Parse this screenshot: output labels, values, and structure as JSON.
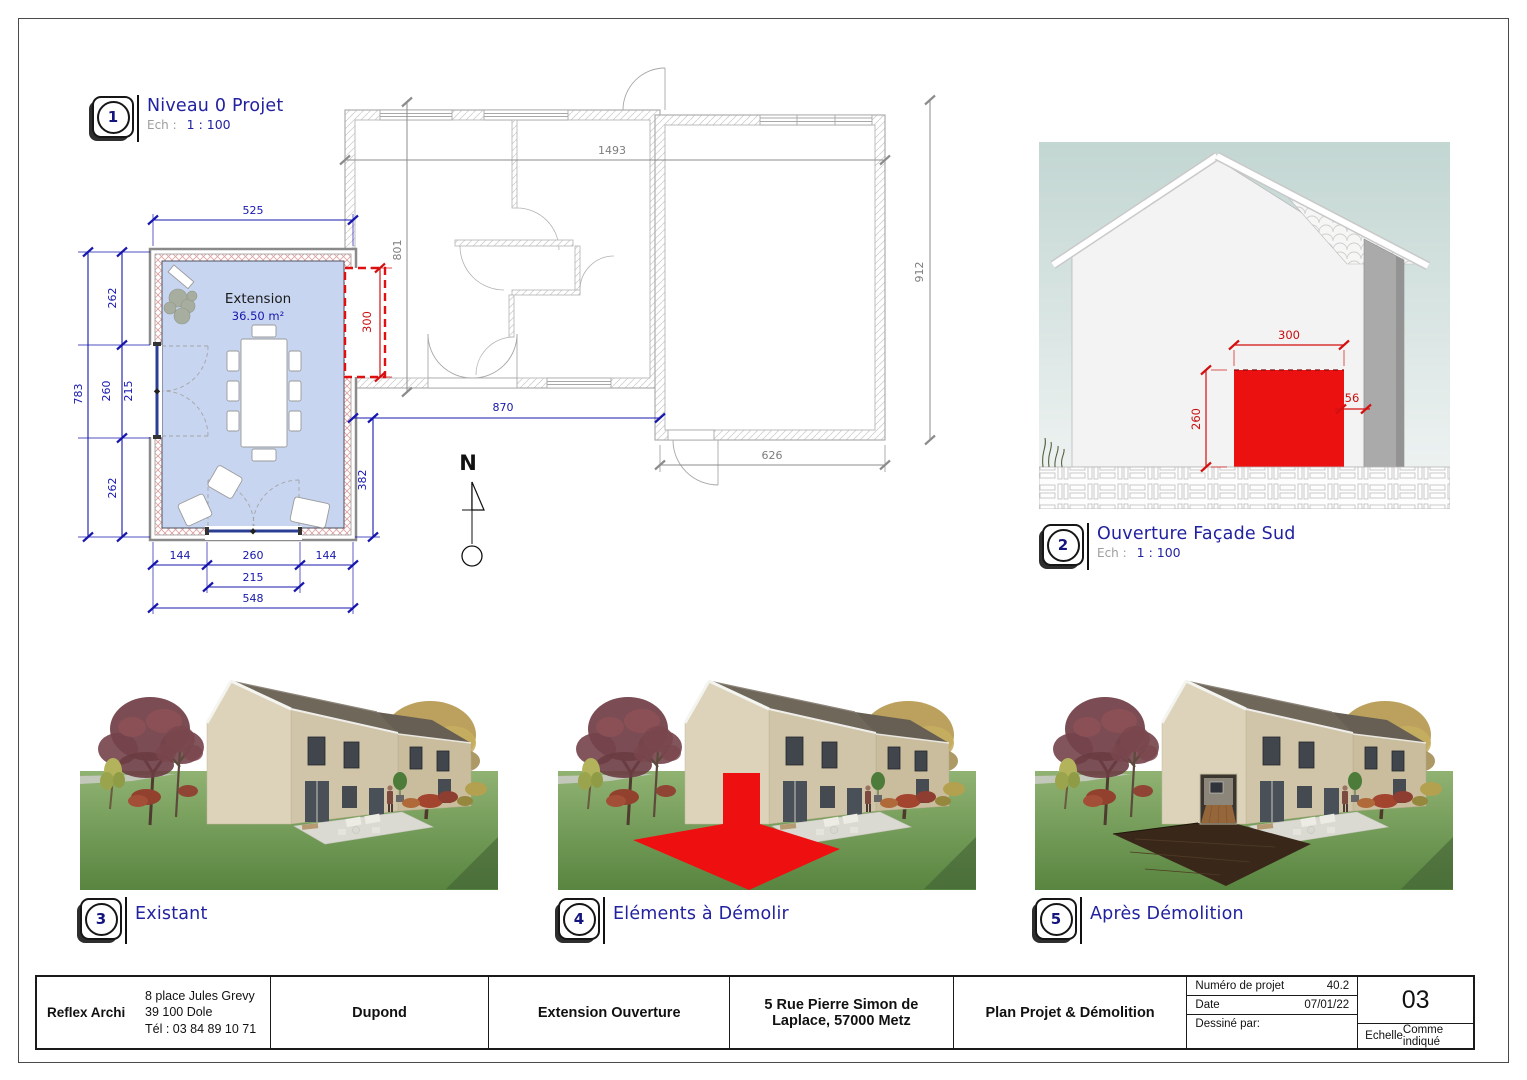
{
  "colors": {
    "navy": "#2222a0",
    "dim_blue": "#1717ad",
    "dim_gray": "#8c8c8c",
    "dim_red": "#d31010",
    "opening_red": "#ec1111",
    "extension_fill": "#c7d5f0",
    "grass_green": "#679550",
    "wall_beige": "#d6cbb2"
  },
  "viewports": [
    {
      "number": "1",
      "title": "Niveau 0 Projet",
      "scale_label": "Ech :",
      "scale": "1 : 100"
    },
    {
      "number": "2",
      "title": "Ouverture Façade Sud",
      "scale_label": "Ech :",
      "scale": "1 : 100"
    },
    {
      "number": "3",
      "title": "Existant"
    },
    {
      "number": "4",
      "title": "Eléments à Démolir"
    },
    {
      "number": "5",
      "title": "Après Démolition"
    }
  ],
  "plan": {
    "room_name": "Extension",
    "room_area": "36.50 m²",
    "north": "N",
    "dims": {
      "top": "525",
      "left_total": "783",
      "left_seg1": "262",
      "left_seg2": "260",
      "left_seg2b": "215",
      "left_seg3": "262",
      "bottom_seg1": "144",
      "bottom_seg2": "260",
      "bottom_seg3": "144",
      "bottom_mid": "215",
      "bottom_total": "548",
      "link": "870",
      "side": "382",
      "opening": "300",
      "house_top": "1493",
      "house_left": "801",
      "house_right": "912",
      "house_bottom": "626"
    }
  },
  "elevation": {
    "dims": {
      "width": "300",
      "height": "260",
      "offset": "56"
    }
  },
  "titleblock": {
    "company": "Reflex Archi",
    "address1": "8 place Jules Grevy",
    "address2": "39 100 Dole",
    "address3": "Tél : 03 84 89 10 71",
    "client": "Dupond",
    "project": "Extension Ouverture",
    "location": "5 Rue Pierre Simon de Laplace, 57000 Metz",
    "sheet_title": "Plan Projet & Démolition",
    "project_number_label": "Numéro de projet",
    "project_number": "40.2",
    "date_label": "Date",
    "date": "07/01/22",
    "drawn_by_label": "Dessiné par:",
    "sheet_number": "03",
    "scale_label": "Echelle",
    "scale_value": "Comme indiqué"
  }
}
